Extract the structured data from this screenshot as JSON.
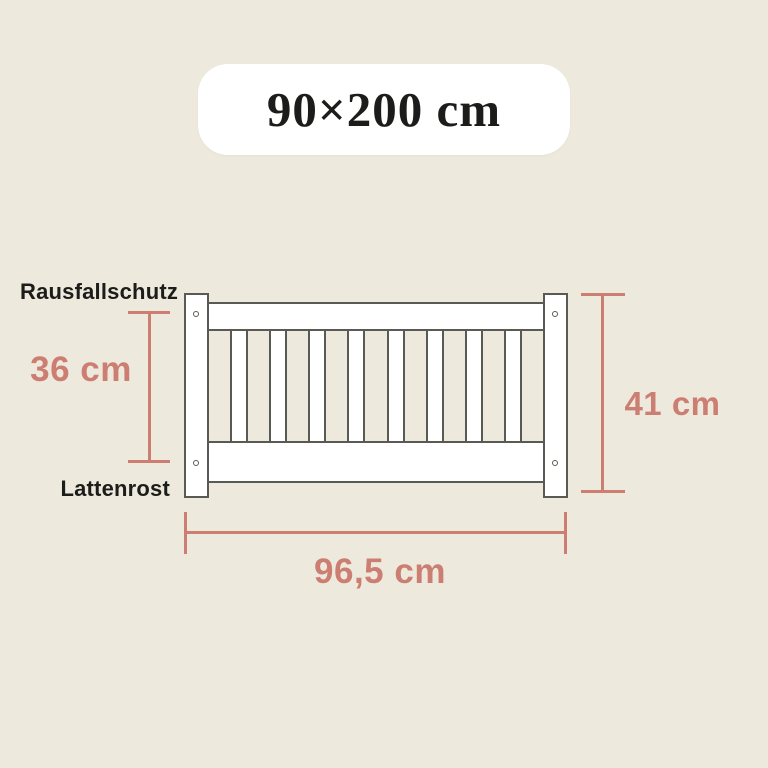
{
  "title": "90×200 cm",
  "labels": {
    "guard_rail": "Rausfallschutz",
    "slatted_base": "Lattenrost"
  },
  "dimensions": {
    "inner_height": "36 cm",
    "outer_height": "41 cm",
    "width": "96,5 cm"
  },
  "diagram": {
    "slat_count": 8,
    "screw_hole_count": 4
  },
  "colors": {
    "background": "#edeadd",
    "panel": "#ffffff",
    "outline": "#5a5a55",
    "accent": "#cd7e72",
    "text": "#1c1c1a"
  }
}
